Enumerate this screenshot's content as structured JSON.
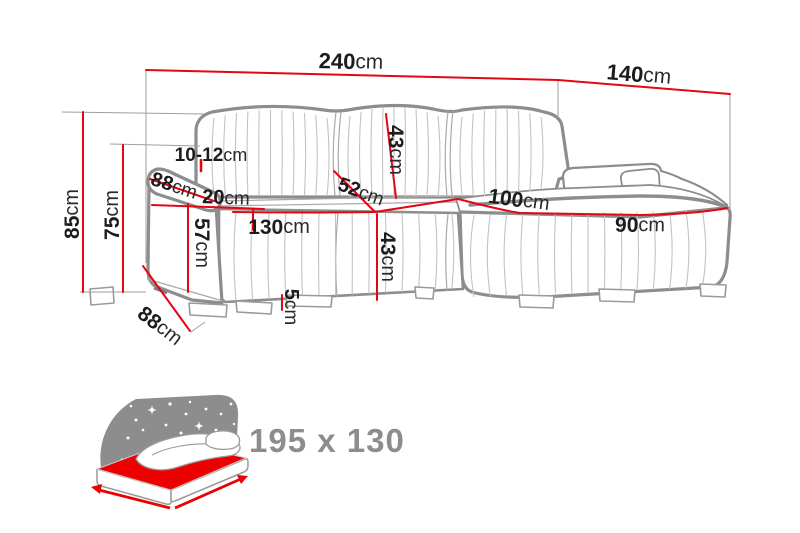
{
  "diagram": {
    "subject": "corner-sofa-dimension-diagram",
    "unit_default": "cm"
  },
  "dimensions": {
    "total_width": {
      "value": "240",
      "unit": "cm"
    },
    "total_depth": {
      "value": "140",
      "unit": "cm"
    },
    "total_height": {
      "value": "85",
      "unit": "cm"
    },
    "armrest_height": {
      "value": "75",
      "unit": "cm"
    },
    "backrest_thickness": {
      "value": "10-12",
      "unit": "cm"
    },
    "armrest_depth_top": {
      "value": "88",
      "unit": "cm"
    },
    "armrest_width": {
      "value": "20",
      "unit": "cm"
    },
    "armrest_front_height": {
      "value": "57",
      "unit": "cm"
    },
    "seat_length": {
      "value": "130",
      "unit": "cm"
    },
    "seat_depth": {
      "value": "52",
      "unit": "cm"
    },
    "backrest_cushion_height": {
      "value": "43",
      "unit": "cm"
    },
    "seat_front_height": {
      "value": "43",
      "unit": "cm"
    },
    "leg_height": {
      "value": "5",
      "unit": "cm"
    },
    "chaise_depth": {
      "value": "100",
      "unit": "cm"
    },
    "chaise_width": {
      "value": "90",
      "unit": "cm"
    },
    "armrest_depth_bottom": {
      "value": "88",
      "unit": "cm"
    }
  },
  "sleeping_area": {
    "icon": "bed-icon",
    "size_label": "195 x 130"
  },
  "colors": {
    "dimension_line_red": "#e30613",
    "bed_accent_red": "#ec0000",
    "outline_gray": "#8d8d8d",
    "label_black": "#1c1c1c",
    "bed_text_gray": "#8d8d8d",
    "star_white": "#ffffff"
  }
}
